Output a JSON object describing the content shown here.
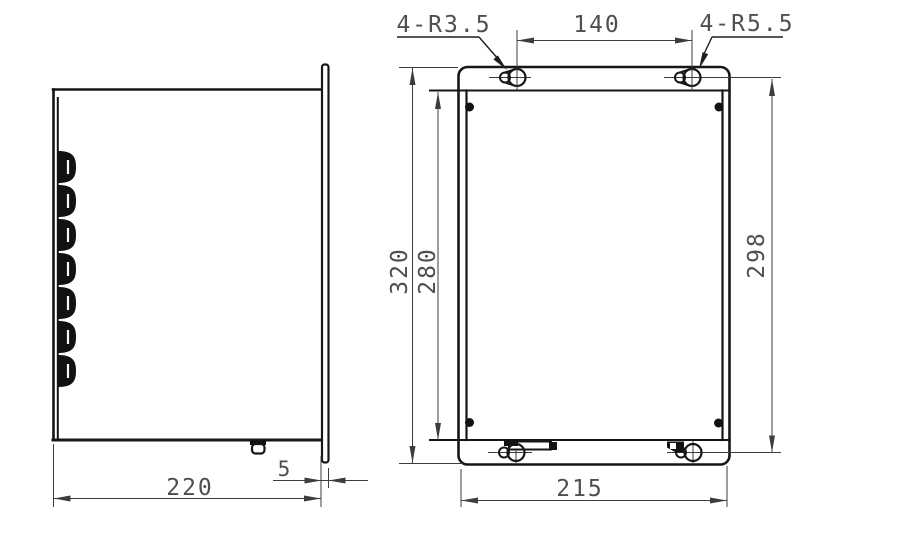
{
  "drawing": {
    "type": "engineering-dimension-drawing",
    "views": {
      "left": "side-view",
      "right": "front-view"
    },
    "colors": {
      "background": "#ffffff",
      "outline": "#161616",
      "dimension_lines": "#3d3d3d",
      "text": "#4f4f4f"
    },
    "annotations": {
      "top_left_hole_label": "4-R3.5",
      "top_right_hole_label": "4-R5.5",
      "hole_spacing_horizontal": "140",
      "overall_height": "320",
      "door_height": "280",
      "mount_hole_spacing_vertical": "298",
      "body_width": "215",
      "body_depth": "220",
      "flange_offset": "5"
    },
    "features": {
      "hinge_knuckle_count": 7,
      "corner_screw_count": 4,
      "keyhole_mount_holes": 4,
      "bottom_cable_clamps": 2
    }
  }
}
